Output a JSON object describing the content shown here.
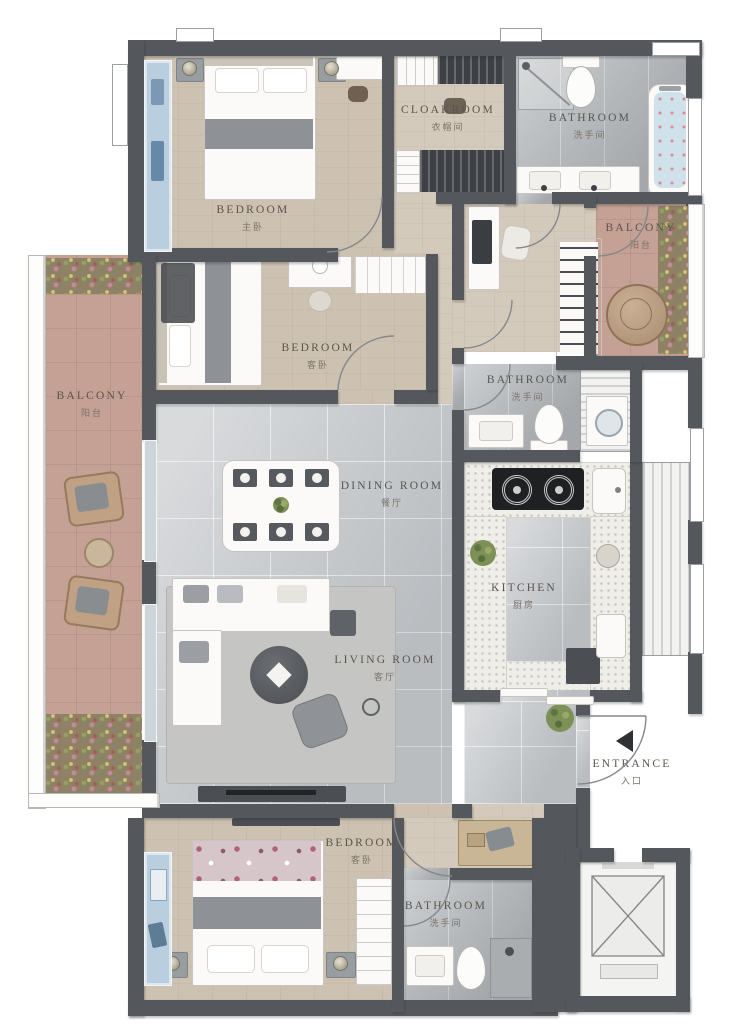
{
  "plan": {
    "rooms": {
      "bedroom_master": {
        "en": "BEDROOM",
        "zh": "主卧"
      },
      "cloakroom": {
        "en": "CLOAKROOM",
        "zh": "衣帽间"
      },
      "bathroom_top": {
        "en": "BATHROOM",
        "zh": "洗手间"
      },
      "balcony_right": {
        "en": "BALCONY",
        "zh": "阳台"
      },
      "bedroom_middle": {
        "en": "BEDROOM",
        "zh": "客卧"
      },
      "balcony_left": {
        "en": "BALCONY",
        "zh": "阳台"
      },
      "dining_room": {
        "en": "DINING ROOM",
        "zh": "餐厅"
      },
      "bathroom_middle": {
        "en": "BATHROOM",
        "zh": "洗手间"
      },
      "kitchen": {
        "en": "KITCHEN",
        "zh": "厨房"
      },
      "living_room": {
        "en": "LIVING ROOM",
        "zh": "客厅"
      },
      "bedroom_bottom": {
        "en": "BEDROOM",
        "zh": "客卧"
      },
      "bathroom_bottom": {
        "en": "BATHROOM",
        "zh": "洗手间"
      }
    },
    "entrance": {
      "en": "ENTRANCE",
      "zh": "入口"
    },
    "colors": {
      "wall": "#54585c",
      "wood_floor": "#cdc2b1",
      "tile_floor": "#c7cacd",
      "marble_floor": "#b4b8bb",
      "balcony_floor": "#c5a094",
      "window_glass": "#b9cedf",
      "bathtub_water": "#cfe1ea",
      "label_text": "#5a544d"
    }
  }
}
